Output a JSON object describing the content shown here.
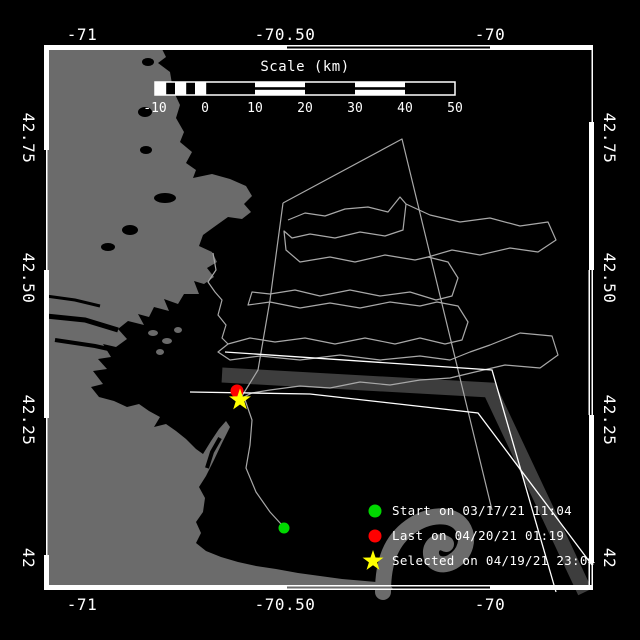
{
  "axes": {
    "top": [
      "-71",
      "-70.50",
      "-70"
    ],
    "bottom": [
      "-71",
      "-70.50",
      "-70"
    ],
    "left": [
      "42.75",
      "42.50",
      "42.25",
      "42"
    ],
    "right": [
      "42.75",
      "42.50",
      "42.25",
      "42"
    ]
  },
  "scale_bar": {
    "title": "Scale (km)",
    "ticks": [
      "-10",
      "0",
      "10",
      "20",
      "30",
      "40",
      "50"
    ]
  },
  "legend": {
    "items": [
      {
        "marker": "circle",
        "color": "#00d800",
        "label": "Start on 03/17/21 11:04"
      },
      {
        "marker": "circle",
        "color": "#ff0000",
        "label": "Last on 04/20/21 01:19"
      },
      {
        "marker": "star",
        "color": "#ffff00",
        "label": "Selected on 04/19/21 23:04"
      }
    ]
  },
  "colors": {
    "water": "#000000",
    "land": "#6b6b6b",
    "frame": "#ffffff",
    "track": "#a8a8a8",
    "lane_band": "#3d3d3d",
    "lane_line": "#ffffff"
  }
}
